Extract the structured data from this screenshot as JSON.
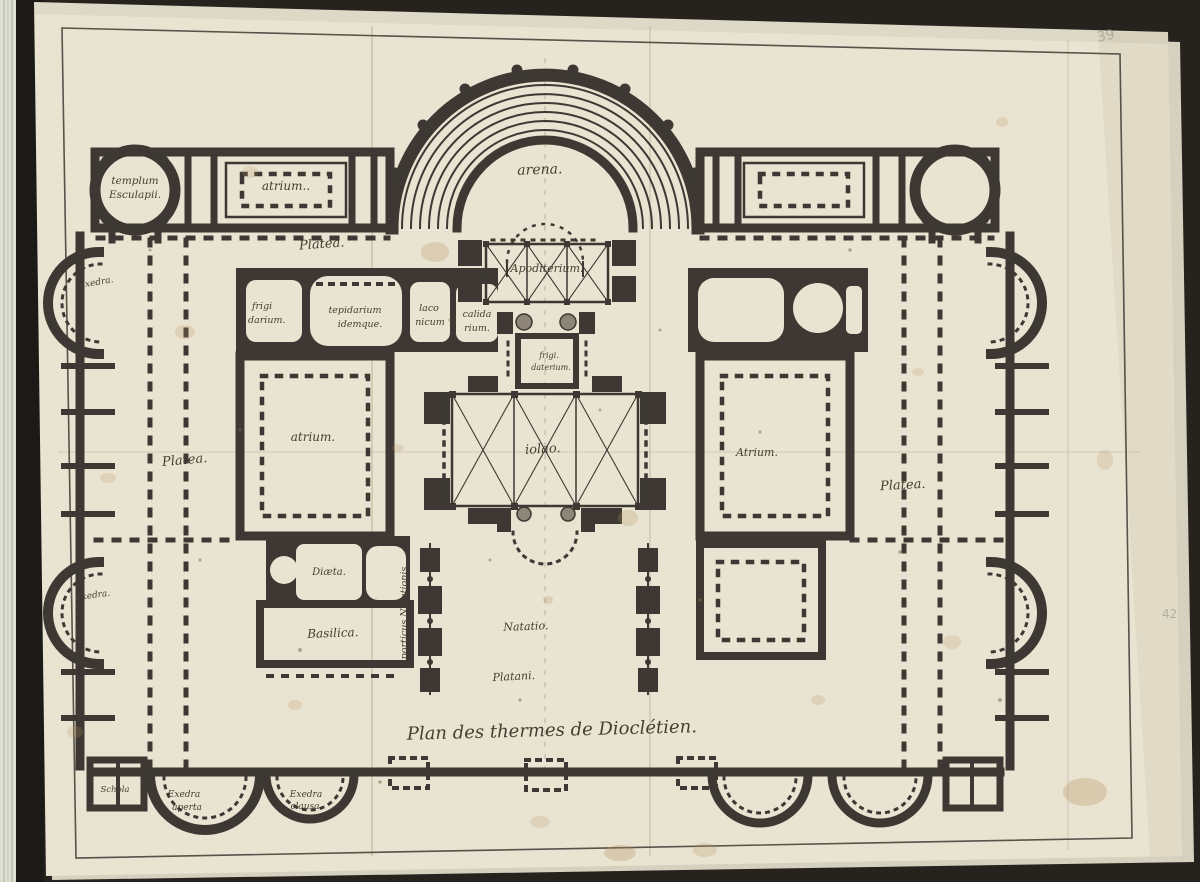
{
  "labels": {
    "templum": {
      "line1": "templum",
      "line2": "Esculapii."
    },
    "atrium_top_left": "atrium..",
    "arena": "arena.",
    "platea_upper_left": "Platea.",
    "apodyterium": "Apoditerium.",
    "frigidarium": {
      "line1": "frigi",
      "line2": "darium."
    },
    "tepidarium": {
      "line1": "tepidarium",
      "line2": "idemque."
    },
    "laconicum": {
      "line1": "laco",
      "line2": "nicum"
    },
    "calidarium": {
      "line1": "calida",
      "line2": "rium."
    },
    "exedra_upper_left": "exedra.",
    "frigidarium_small": {
      "line1": "frigi.",
      "line2": "daterium."
    },
    "atrium_left": "atrium.",
    "central_hall": "iolao.",
    "atrium_right": "Atrium.",
    "platea_left": "Platea.",
    "platea_right": "Platea.",
    "exedra_lower_left": "Exedra.",
    "diaeta": "Diæta.",
    "basilica": "Basilica.",
    "porticus": "porticus Natationis",
    "natatio": "Natatio.",
    "platani": "Platani.",
    "schola": "Schola",
    "exedra_aperta": {
      "line1": "Exedra",
      "line2": "aperta"
    },
    "exedra_clausa": {
      "line1": "Exedra",
      "line2": "clausa"
    },
    "title": "Plan des thermes de Dioclétien."
  },
  "annotations": {
    "folio_number": "39",
    "edge_number": "42"
  },
  "colors": {
    "paper": "#e9e3d1",
    "ink": "#3d3833",
    "background": "#26231f",
    "pencil": "#96907f",
    "stain": "#b5935e"
  }
}
